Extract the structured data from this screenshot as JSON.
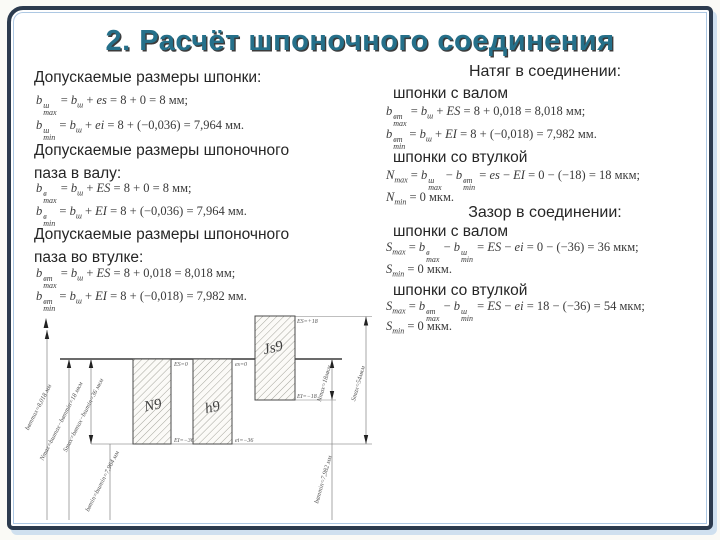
{
  "title": "2. Расчёт шпоночного соединения",
  "left_column": {
    "section_key": {
      "heading": "Допускаемые размеры шпонки:",
      "f1": "b_{max}^{ш} = b_{ш} + es = 8 + 0 = 8 мм;",
      "f2": "b_{min}^{ш} = b_{ш} + ei = 8 + (−0,036) = 7,964 мм."
    },
    "section_shaft": {
      "heading_line1": "Допускаемые размеры шпоночного",
      "heading_line2": "паза в валу:",
      "f1": "b_{max}^{в} = b_{ш} + ES = 8 + 0 = 8 мм;",
      "f2": "b_{min}^{в} = b_{ш} + EI = 8 + (−0,036) = 7,964 мм."
    },
    "section_bush": {
      "heading_line1": "Допускаемые размеры шпоночного",
      "heading_line2": "паза во втулке:",
      "f1": "b_{max}^{вт} = b_{ш} + ES = 8 + 0,018 = 8,018 мм;",
      "f2": "b_{min}^{вт} = b_{ш} + EI = 8 + (−0,018) = 7,982 мм."
    }
  },
  "right_column": {
    "heading_natyag": "Натяг в соединении:",
    "label_shaft_1": "шпонки с валом",
    "natyag_shaft_f1": "b_{max}^{вт} = b_{ш} + ES = 8 + 0,018 = 8,018 мм;",
    "natyag_shaft_f2": "b_{min}^{вт} = b_{ш} + EI = 8 + (−0,018) = 7,982 мм.",
    "label_bush_1": "шпонки со втулкой",
    "natyag_bush_f1": "N_{max} = b_{max}^{ш} − b_{min}^{вт} = es − EI = 0 − (−18) = 18 мкм;",
    "natyag_bush_f2": "N_{min} = 0 мкм.",
    "heading_zazor": "Зазор в соединении:",
    "label_shaft_2": "шпонки с валом",
    "zazor_shaft_f1": "S_{max} = b_{max}^{в} − b_{min}^{ш} = ES − ei = 0 − (−36) = 36 мкм;",
    "zazor_shaft_f2": "S_{min} = 0 мкм.",
    "label_bush_2": "шпонки со втулкой",
    "zazor_bush_f1": "S_{max} = b_{max}^{вт} − b_{min}^{ш} = ES − ei = 18 − (−36) = 54 мкм;",
    "zazor_bush_f2": "S_{min} = 0 мкм."
  },
  "diagram": {
    "box_labels": [
      "N9",
      "h9",
      "Js9"
    ],
    "corner_labels": {
      "n9_top": "ES=0",
      "n9_bot": "EI=−36",
      "h9_top": "es=0",
      "h9_bot": "ei=−36",
      "js9_top": "ES=+18",
      "js9_bot": "EI=−18"
    },
    "dim_labels": {
      "left_1": "bвтmax=8,018 мм",
      "left_2": "Nmax=bшmax−bвтmin=18 мкм",
      "left_3": "Smax=bвmax−bшmin=36 мкм",
      "left_4": "bвmin=bшmin=7,964 мм",
      "right_1": "Nmax=18мкм",
      "right_2": "Smax=54мкм",
      "right_3": "bвтmin=7,982 мм"
    }
  }
}
